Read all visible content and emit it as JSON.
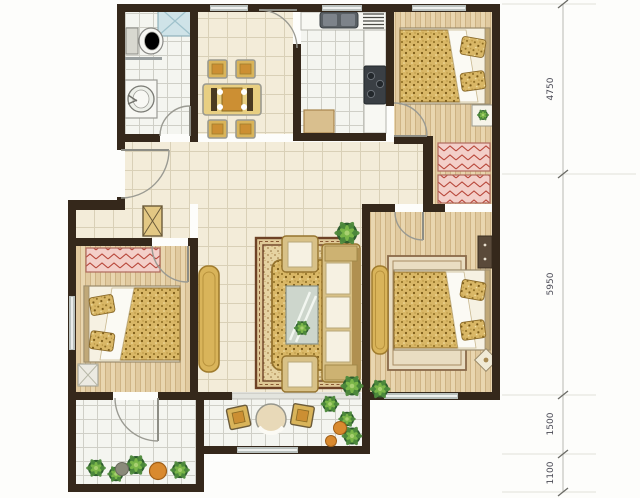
{
  "dimensions": {
    "labels": [
      "4750",
      "5950",
      "1500",
      "1100"
    ]
  },
  "rooms": [
    "bathroom",
    "dining-area",
    "kitchen",
    "bedroom-top",
    "hallway",
    "living-room",
    "bedroom-left",
    "bedroom-right",
    "walk-in-closet",
    "balcony-left",
    "balcony-main"
  ],
  "fixtures": [
    "shower",
    "toilet",
    "washbasin",
    "dining-table-set",
    "kitchen-sink",
    "drying-rack",
    "stove",
    "kitchen-cabinet",
    "double-bed",
    "nightstand",
    "wardrobe",
    "shoe-cabinet",
    "tv-cabinet",
    "sofa",
    "armchair",
    "coffee-table",
    "area-rug",
    "dresser",
    "balcony-table",
    "balcony-chair",
    "potted-plant",
    "planter"
  ],
  "colors": {
    "wall": "#35281b",
    "floor-cream": "#f3ecd9",
    "grout-cream": "#d9d0b7",
    "floor-white": "#f4f5f0",
    "grout-white": "#cfcfc7",
    "wood": "#e9d6b0",
    "wood-grain": "#c9ac7c",
    "gold": "#d9b45a",
    "gold-dark": "#a07c2e",
    "speckle": "#d9b766",
    "pink": "#f3cfc9",
    "pink-hatch": "#b8473a",
    "shower": "#cfe3e8",
    "fabric": "#f6f1e2",
    "frame-tan": "#d8c187",
    "rug-border": "#6e4226",
    "rug-fill": "#e6d3a2",
    "plant": "#4e8a3c",
    "plant-dark": "#2e5d2e",
    "pot": "#d98a2f",
    "appliance": "#3a3f44",
    "dim-line": "#b9b9b3",
    "dim-text": "#4a4a55"
  }
}
